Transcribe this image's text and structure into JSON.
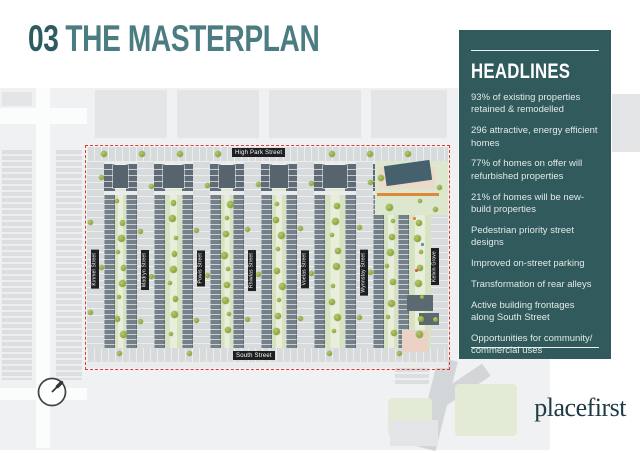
{
  "slide": {
    "title_number": "03",
    "title_text": "THE MASTERPLAN"
  },
  "headlines": {
    "title": "HEADLINES",
    "items": [
      "93% of existing properties retained & remodelled",
      "296 attractive, energy efficient homes",
      "77% of homes on offer will refurbished properties",
      "21% of homes will be new-build properties",
      "Pedestrian priority street designs",
      "Improved on-street parking",
      "Transformation of rear alleys",
      "Active building frontages along South Street",
      "Opportunities for community/ commercial uses"
    ]
  },
  "map": {
    "horizontal_streets": {
      "top": "High Park Street",
      "bottom": "South Street"
    },
    "vertical_streets": [
      "Kinmel Street",
      "Madryn Street",
      "Powis Street",
      "Rhiwlas Street",
      "Voelas Street",
      "Wynnstay Street",
      "Kelvin Grove"
    ],
    "boundary_style": "red-dashed",
    "compass": "north-arrow"
  },
  "logo": {
    "text": "placefirst"
  },
  "colors": {
    "title_teal": "#4A7C82",
    "title_teal_dark": "#2C5B61",
    "panel_bg": "#305A5B",
    "panel_text": "#E3E9E8",
    "boundary_red": "#E23A2E",
    "tree_green": "#8FAE3E",
    "logo_teal": "#1E3B46"
  }
}
